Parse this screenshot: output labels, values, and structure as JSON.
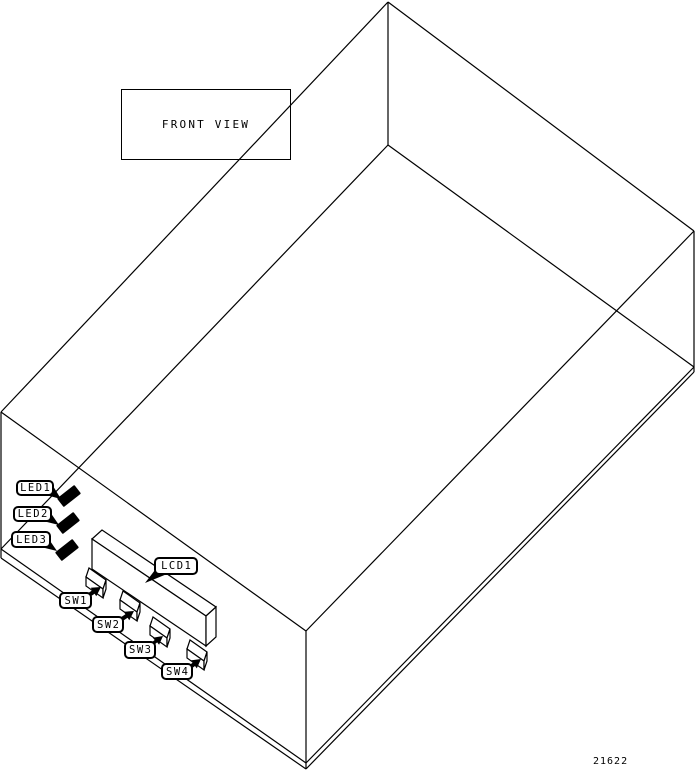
{
  "diagram": {
    "title": "FRONT VIEW",
    "figure_number": "21622",
    "colors": {
      "line": "#000000",
      "background": "#ffffff",
      "label_fill": "#ffffff"
    },
    "labels": {
      "led1": "LED1",
      "led2": "LED2",
      "led3": "LED3",
      "lcd1": "LCD1",
      "sw1": "SW1",
      "sw2": "SW2",
      "sw3": "SW3",
      "sw4": "SW4"
    }
  }
}
